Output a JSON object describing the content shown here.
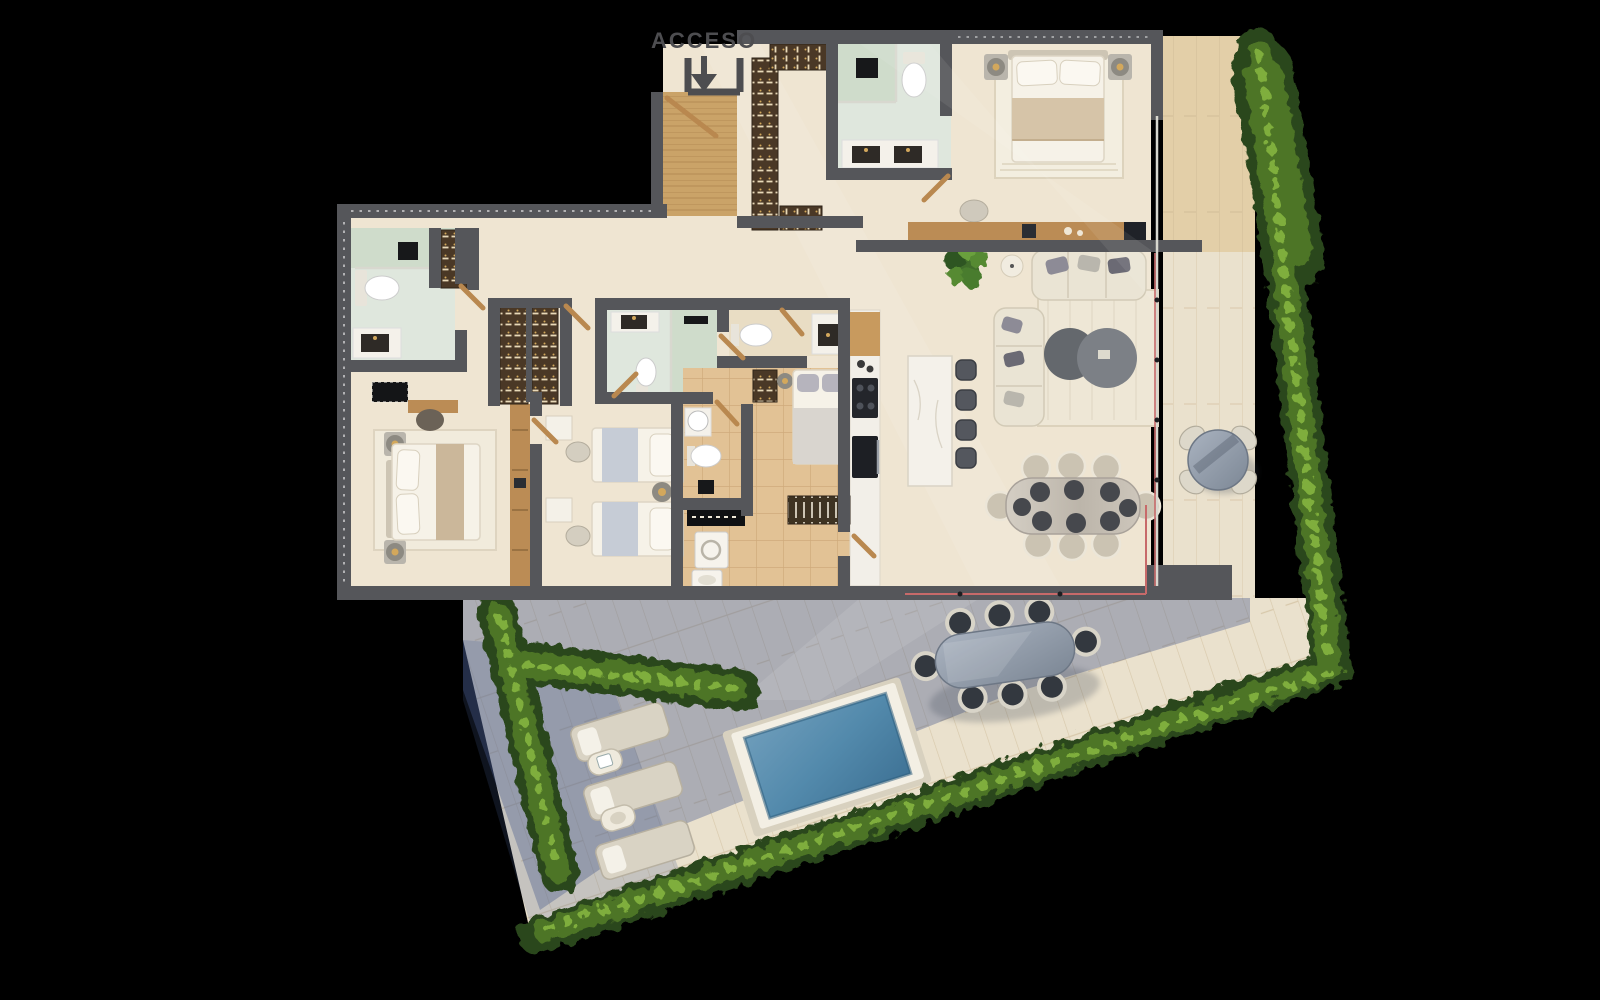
{
  "plan": {
    "access_label": "ACCESO",
    "access_arrow_icon": "arrow-down-icon"
  },
  "colors": {
    "background": "#000000",
    "wall": "#55565a",
    "text": "#4d4d50",
    "floor-cream": "#efe5d2",
    "floor-cream-light": "#f8f0de",
    "floor-tan": "#e2c295",
    "grout-tan": "#b98f5c",
    "floor-bath": "#dfe7dd",
    "shower-marble": "#cfdccb",
    "wood": "#bf8f57",
    "wood-light": "#e3cfa8",
    "closet-dark": "#4a3826",
    "stone": "#eae1cd",
    "terrace-shadow": "#46598c",
    "water": "#538aac",
    "water-deep": "#3f7396",
    "hedge-dark": "#2c471d",
    "hedge-mid": "#4d7426",
    "hedge-light": "#7fae3c",
    "furniture-white": "#f1ede1",
    "furniture-gray": "#9b99a1",
    "furniture-dark": "#3c4046",
    "marble-table": "#c9c2b8",
    "accent-track": "#c76a6a",
    "gold": "#d3a85c"
  },
  "scene": {
    "rooms": [
      "entry",
      "foyer",
      "walk-in-closet",
      "master-bathroom",
      "master-bedroom",
      "living-room",
      "kitchen",
      "dining-room",
      "hallway",
      "bedroom-2",
      "ensuite-bathroom",
      "guest-toilet",
      "twin-bedroom",
      "service-bathroom",
      "service-bedroom",
      "laundry",
      "balcony",
      "terrace",
      "pool-deck"
    ],
    "furniture": [
      "double-bed",
      "twin-beds",
      "single-bed",
      "sofa",
      "coffee-tables",
      "rug",
      "dining-table-8-seats",
      "kitchen-island",
      "bar-stools",
      "cooktop",
      "oven",
      "double-vanity",
      "toilet",
      "shower",
      "wardrobes",
      "washer",
      "drying-rack",
      "outdoor-dining-table",
      "bistro-table",
      "sun-loungers",
      "pool",
      "hedge",
      "plant"
    ]
  }
}
